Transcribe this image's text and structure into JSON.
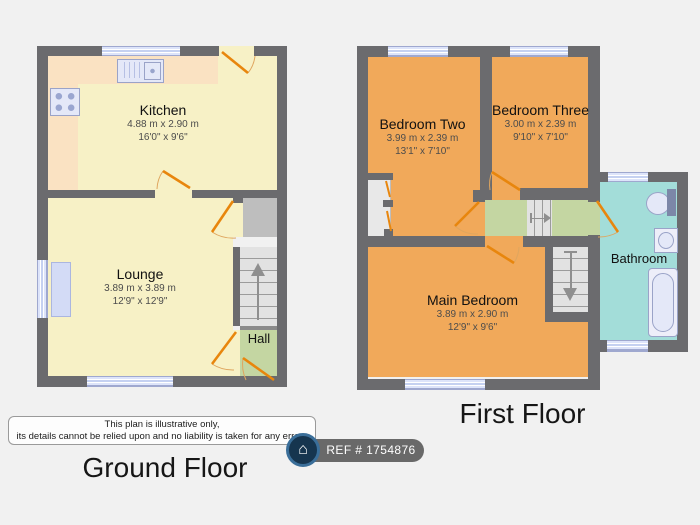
{
  "floors": {
    "ground": {
      "title": "Ground Floor",
      "rooms": {
        "kitchen": {
          "name": "Kitchen",
          "metric": "4.88 m x 2.90 m",
          "imperial": "16'0\" x 9'6\""
        },
        "lounge": {
          "name": "Lounge",
          "metric": "3.89 m x 3.89 m",
          "imperial": "12'9\" x 12'9\""
        },
        "hall": {
          "name": "Hall"
        }
      }
    },
    "first": {
      "title": "First Floor",
      "rooms": {
        "bedroom_two": {
          "name": "Bedroom Two",
          "metric": "3.99 m x 2.39 m",
          "imperial": "13'1\" x 7'10\""
        },
        "bedroom_three": {
          "name": "Bedroom Three",
          "metric": "3.00 m x 2.39 m",
          "imperial": "9'10\" x 7'10\""
        },
        "main_bedroom": {
          "name": "Main Bedroom",
          "metric": "3.89 m x 2.90 m",
          "imperial": "12'9\" x 9'6\""
        },
        "bathroom": {
          "name": "Bathroom"
        }
      }
    }
  },
  "disclaimer": {
    "line1": "This plan is illustrative only,",
    "line2": "its details cannot be relied upon and no liability is taken for any errors"
  },
  "badge": {
    "ref": "REF # 1754876",
    "icon": "house-icon",
    "icon_glyph": "⌂"
  },
  "colors": {
    "wall": "#6B6B6E",
    "room_yellow": "#F7F1C6",
    "room_orange": "#F1A95A",
    "room_green": "#C4D6A2",
    "room_teal": "#A3DDD9",
    "counter": "#FAE2C2",
    "stairs": "#E2E2E2",
    "cupboard": "#BEBEBE",
    "closet": "#E8E8E8",
    "door": "#E8860D",
    "door_arc": "#DFA65F",
    "window_blue": "#C5D1F1",
    "fixture_fill": "#E4E8F8",
    "fixture_line": "#9AA3C8",
    "background": "#F1F1F1",
    "badge_gray": "#696969",
    "badge_circle": "#16354F",
    "badge_ring": "#3A6E99",
    "text": "#111111",
    "dim_text": "#4C4C4C",
    "step_line": "#9B9B9B"
  }
}
